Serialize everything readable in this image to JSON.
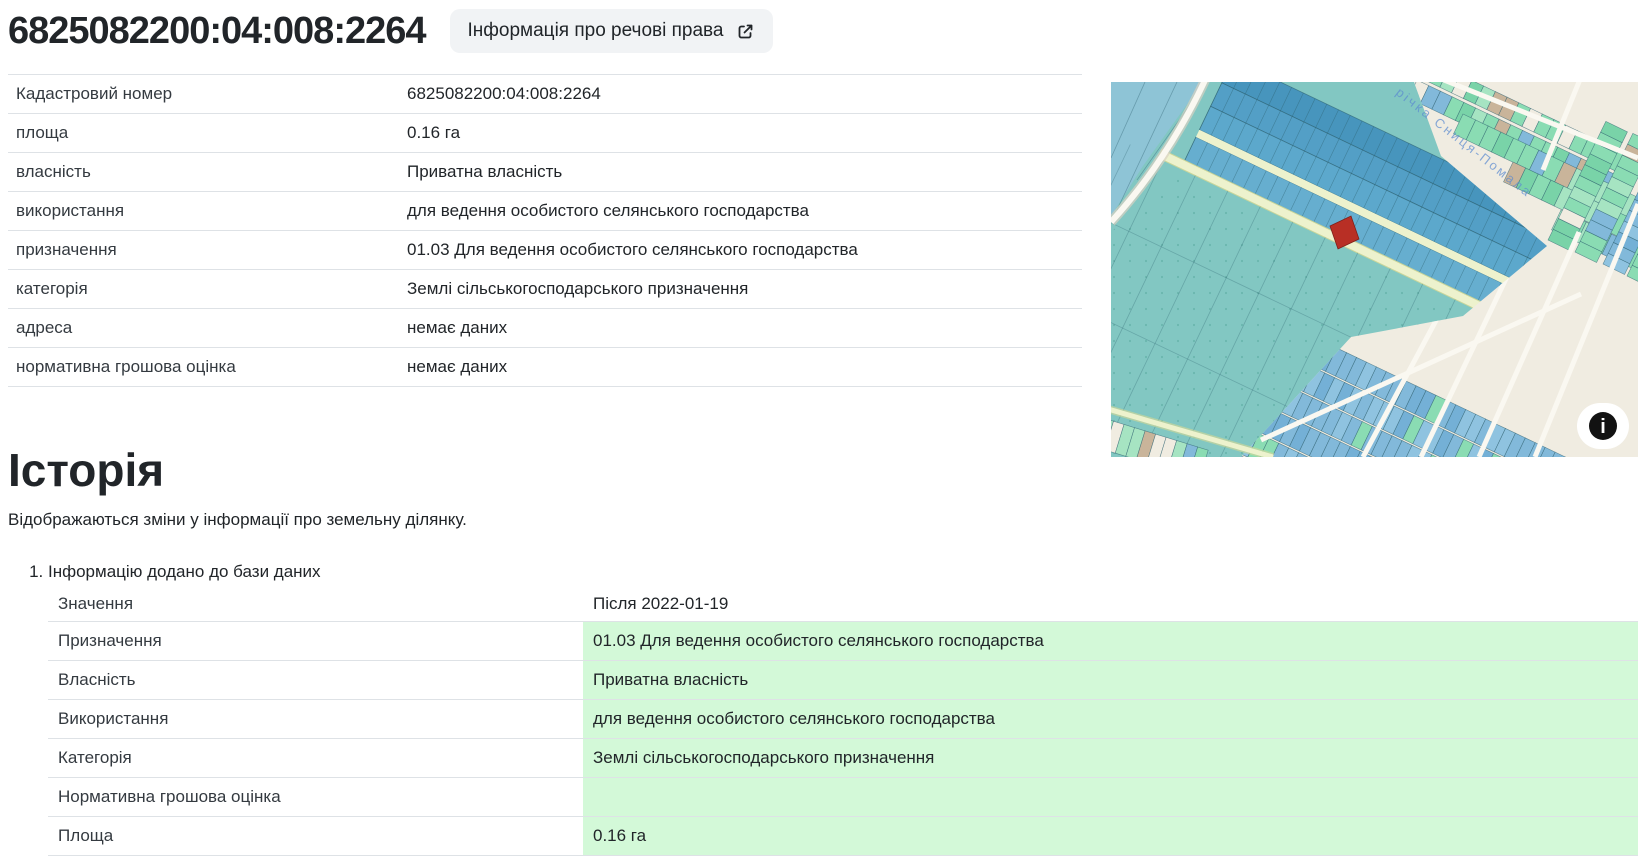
{
  "header": {
    "title": "6825082200:04:008:2264",
    "rights_button": "Інформація про речові права"
  },
  "details": {
    "rows": [
      {
        "label": "Кадастровий номер",
        "value": "6825082200:04:008:2264"
      },
      {
        "label": "площа",
        "value": "0.16 га"
      },
      {
        "label": "власність",
        "value": "Приватна власність"
      },
      {
        "label": "використання",
        "value": "для ведення особистого селянського господарства"
      },
      {
        "label": "призначення",
        "value": "01.03 Для ведення особистого селянського господарства"
      },
      {
        "label": "категорія",
        "value": "Землі сільськогосподарського призначення"
      },
      {
        "label": "адреса",
        "value": "немає даних"
      },
      {
        "label": "нормативна грошова оцінка",
        "value": "немає даних"
      }
    ]
  },
  "history": {
    "heading": "Історія",
    "description": "Відображаються зміни у інформації про земельну ділянку.",
    "entries": [
      {
        "title": "Інформацію додано до бази даних",
        "value_header": "Значення",
        "date_header": "Після 2022-01-19",
        "rows": [
          {
            "label": "Призначення",
            "value": "01.03 Для ведення особистого селянського господарства"
          },
          {
            "label": "Власність",
            "value": "Приватна власність"
          },
          {
            "label": "Використання",
            "value": "для ведення особистого селянського господарства"
          },
          {
            "label": "Категорія",
            "value": "Землі сільськогосподарського призначення"
          },
          {
            "label": "Нормативна грошова оцінка",
            "value": ""
          },
          {
            "label": "Площа",
            "value": "0.16 га"
          }
        ]
      }
    ]
  },
  "map": {
    "river_label": "річка Сниця-Помала",
    "colors": {
      "background": "#f0ece1",
      "field_teal": "#82c7c2",
      "field_tint_blue": "#8fc3d8",
      "strip_blue_1": "#4795bd",
      "strip_blue_2": "#539fc6",
      "strip_blue_3": "#5ca8cc",
      "strip_blue_4": "#66aecf",
      "parcel_green": "#8adcb3",
      "parcel_blue": "#82b9da",
      "building_tan": "#c9b49a",
      "selected_parcel_red": "#b82f25",
      "road_white": "#faf8f1",
      "road_yellow": "#edf2cd",
      "outline": "#2c5f6e",
      "label_blue": "#5b8bd0"
    }
  },
  "colors": {
    "highlight_green": "#d3f9d8",
    "border": "#dee2e6",
    "button_bg": "#f1f3f5",
    "text": "#212529"
  }
}
